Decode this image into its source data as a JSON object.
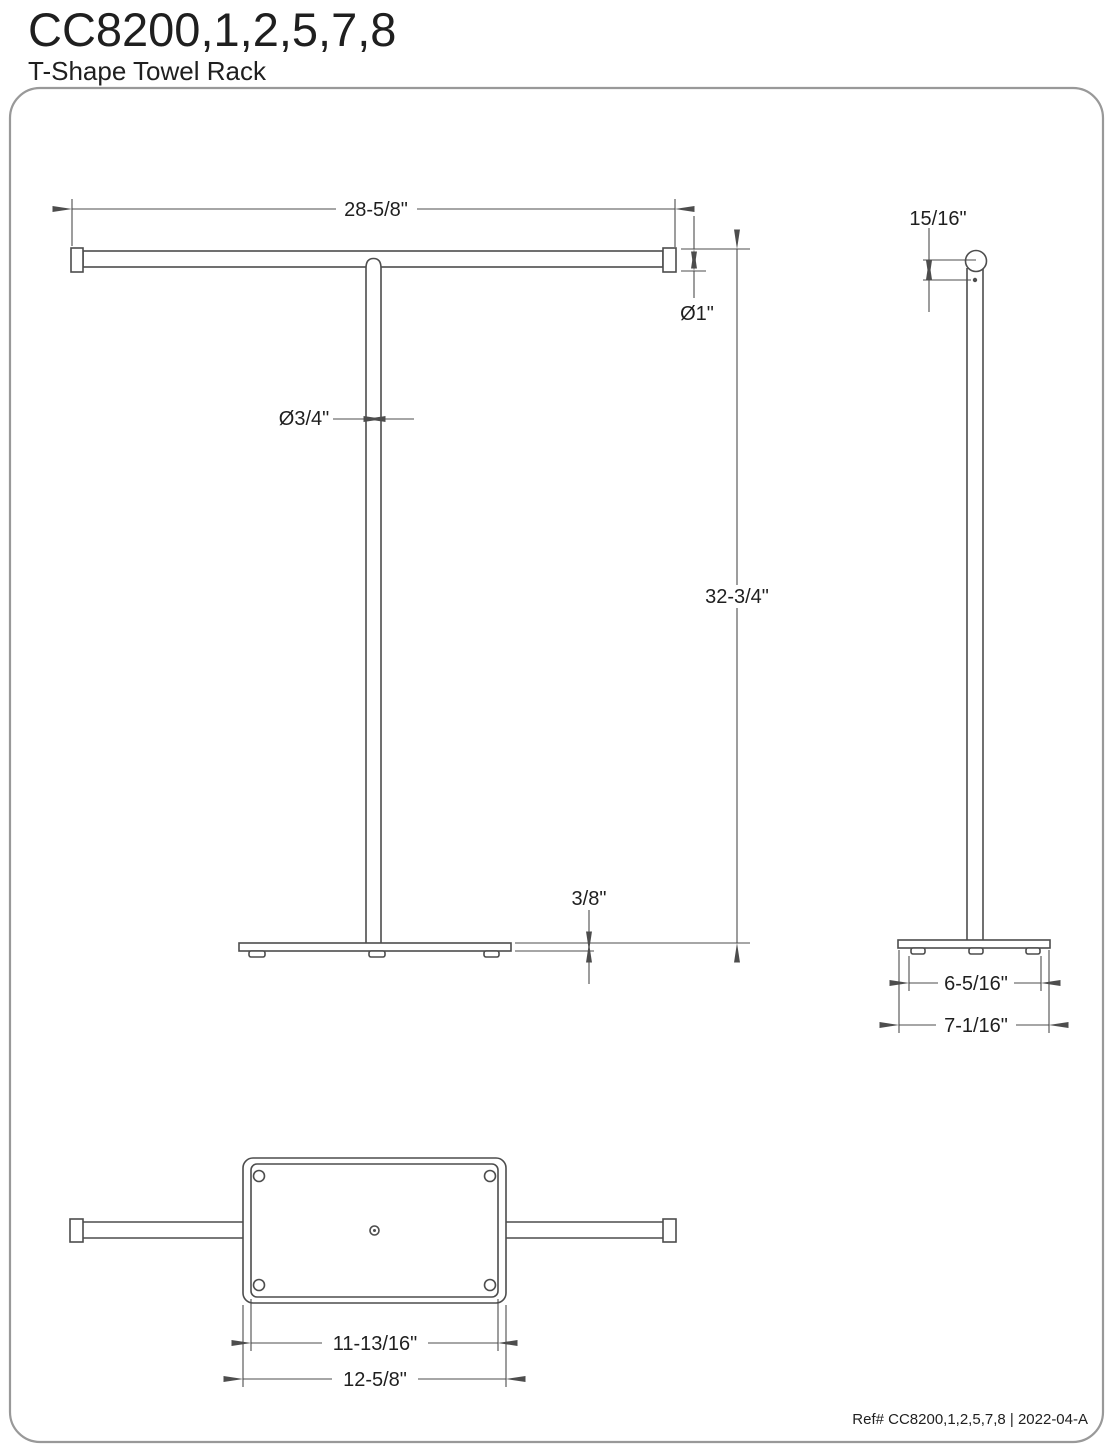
{
  "header": {
    "model_number": "CC8200,1,2,5,7,8",
    "product_name": "T-Shape Towel Rack"
  },
  "views": {
    "front": {
      "bar_length": "28-5/8\"",
      "bar_diameter": "Ø1\"",
      "pole_diameter": "Ø3/4\"",
      "overall_height": "32-3/4\"",
      "base_thickness": "3/8\""
    },
    "side": {
      "bar_top_offset": "15/16\"",
      "feet_spacing": "6-5/16\"",
      "base_depth": "7-1/16\""
    },
    "bottom": {
      "mount_plate_width": "11-13/16\"",
      "base_width": "12-5/8\""
    }
  },
  "footer": {
    "reference": "Ref# CC8200,1,2,5,7,8 | 2022-04-A"
  },
  "colors": {
    "line": "#4d4d4d",
    "text": "#1f1f1f",
    "border": "#999999",
    "background": "#ffffff"
  }
}
